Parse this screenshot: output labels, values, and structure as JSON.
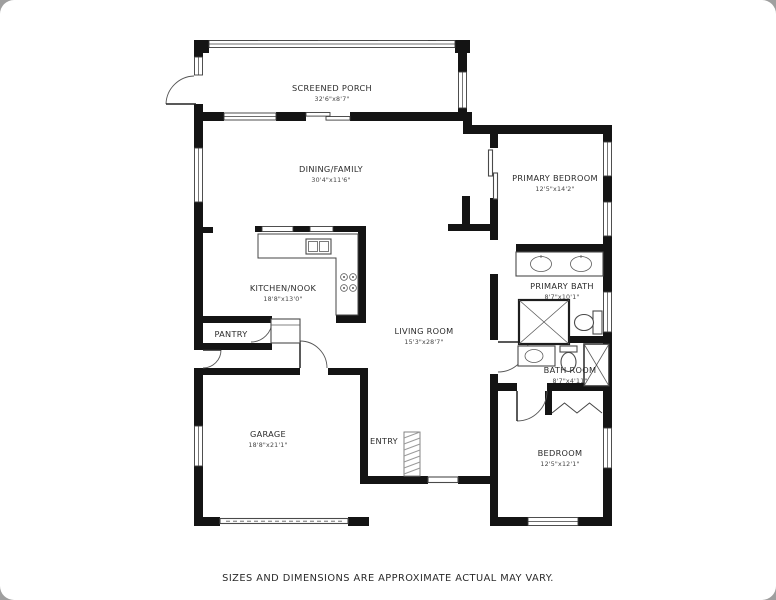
{
  "canvas": {
    "width": 776,
    "height": 600,
    "background": "#ffffff",
    "corner_background": "#9f9f9f",
    "wall_color": "#141414",
    "line_color": "#3c3c3c"
  },
  "disclaimer": "SIZES AND DIMENSIONS ARE APPROXIMATE ACTUAL MAY VARY.",
  "rooms": [
    {
      "id": "screened-porch",
      "name": "SCREENED PORCH",
      "dims": "32'6\"x8'7\"",
      "cx": 332,
      "cy": 91
    },
    {
      "id": "dining-family",
      "name": "DINING/FAMILY",
      "dims": "30'4\"x11'6\"",
      "cx": 331,
      "cy": 172
    },
    {
      "id": "primary-bedroom",
      "name": "PRIMARY BEDROOM",
      "dims": "12'5\"x14'2\"",
      "cx": 555,
      "cy": 181
    },
    {
      "id": "kitchen-nook",
      "name": "KITCHEN/NOOK",
      "dims": "18'8\"x13'0\"",
      "cx": 283,
      "cy": 291
    },
    {
      "id": "pantry",
      "name": "PANTRY",
      "dims": "",
      "cx": 231,
      "cy": 337
    },
    {
      "id": "living-room",
      "name": "LIVING ROOM",
      "dims": "15'3\"x28'7\"",
      "cx": 424,
      "cy": 334
    },
    {
      "id": "primary-bath",
      "name": "PRIMARY BATH",
      "dims": "8'7\"x10'1\"",
      "cx": 562,
      "cy": 289
    },
    {
      "id": "bath-room",
      "name": "BATH ROOM",
      "dims": "8'7\"x4'11\"",
      "cx": 570,
      "cy": 373
    },
    {
      "id": "garage",
      "name": "GARAGE",
      "dims": "18'8\"x21'1\"",
      "cx": 268,
      "cy": 437
    },
    {
      "id": "entry",
      "name": "ENTRY",
      "dims": "",
      "cx": 384,
      "cy": 444
    },
    {
      "id": "bedroom",
      "name": "BEDROOM",
      "dims": "12'5\"x12'1\"",
      "cx": 560,
      "cy": 456
    }
  ],
  "fixtures": [
    "kitchen-sink",
    "stove-cooktop",
    "refrigerator",
    "kitchen-counter",
    "double-vanity-sinks",
    "shower",
    "toilet",
    "bathtub",
    "bath-sink",
    "bath-toilet",
    "entry-mat",
    "garage-door",
    "closet-bifold-doors",
    "closet-sliding-door"
  ]
}
